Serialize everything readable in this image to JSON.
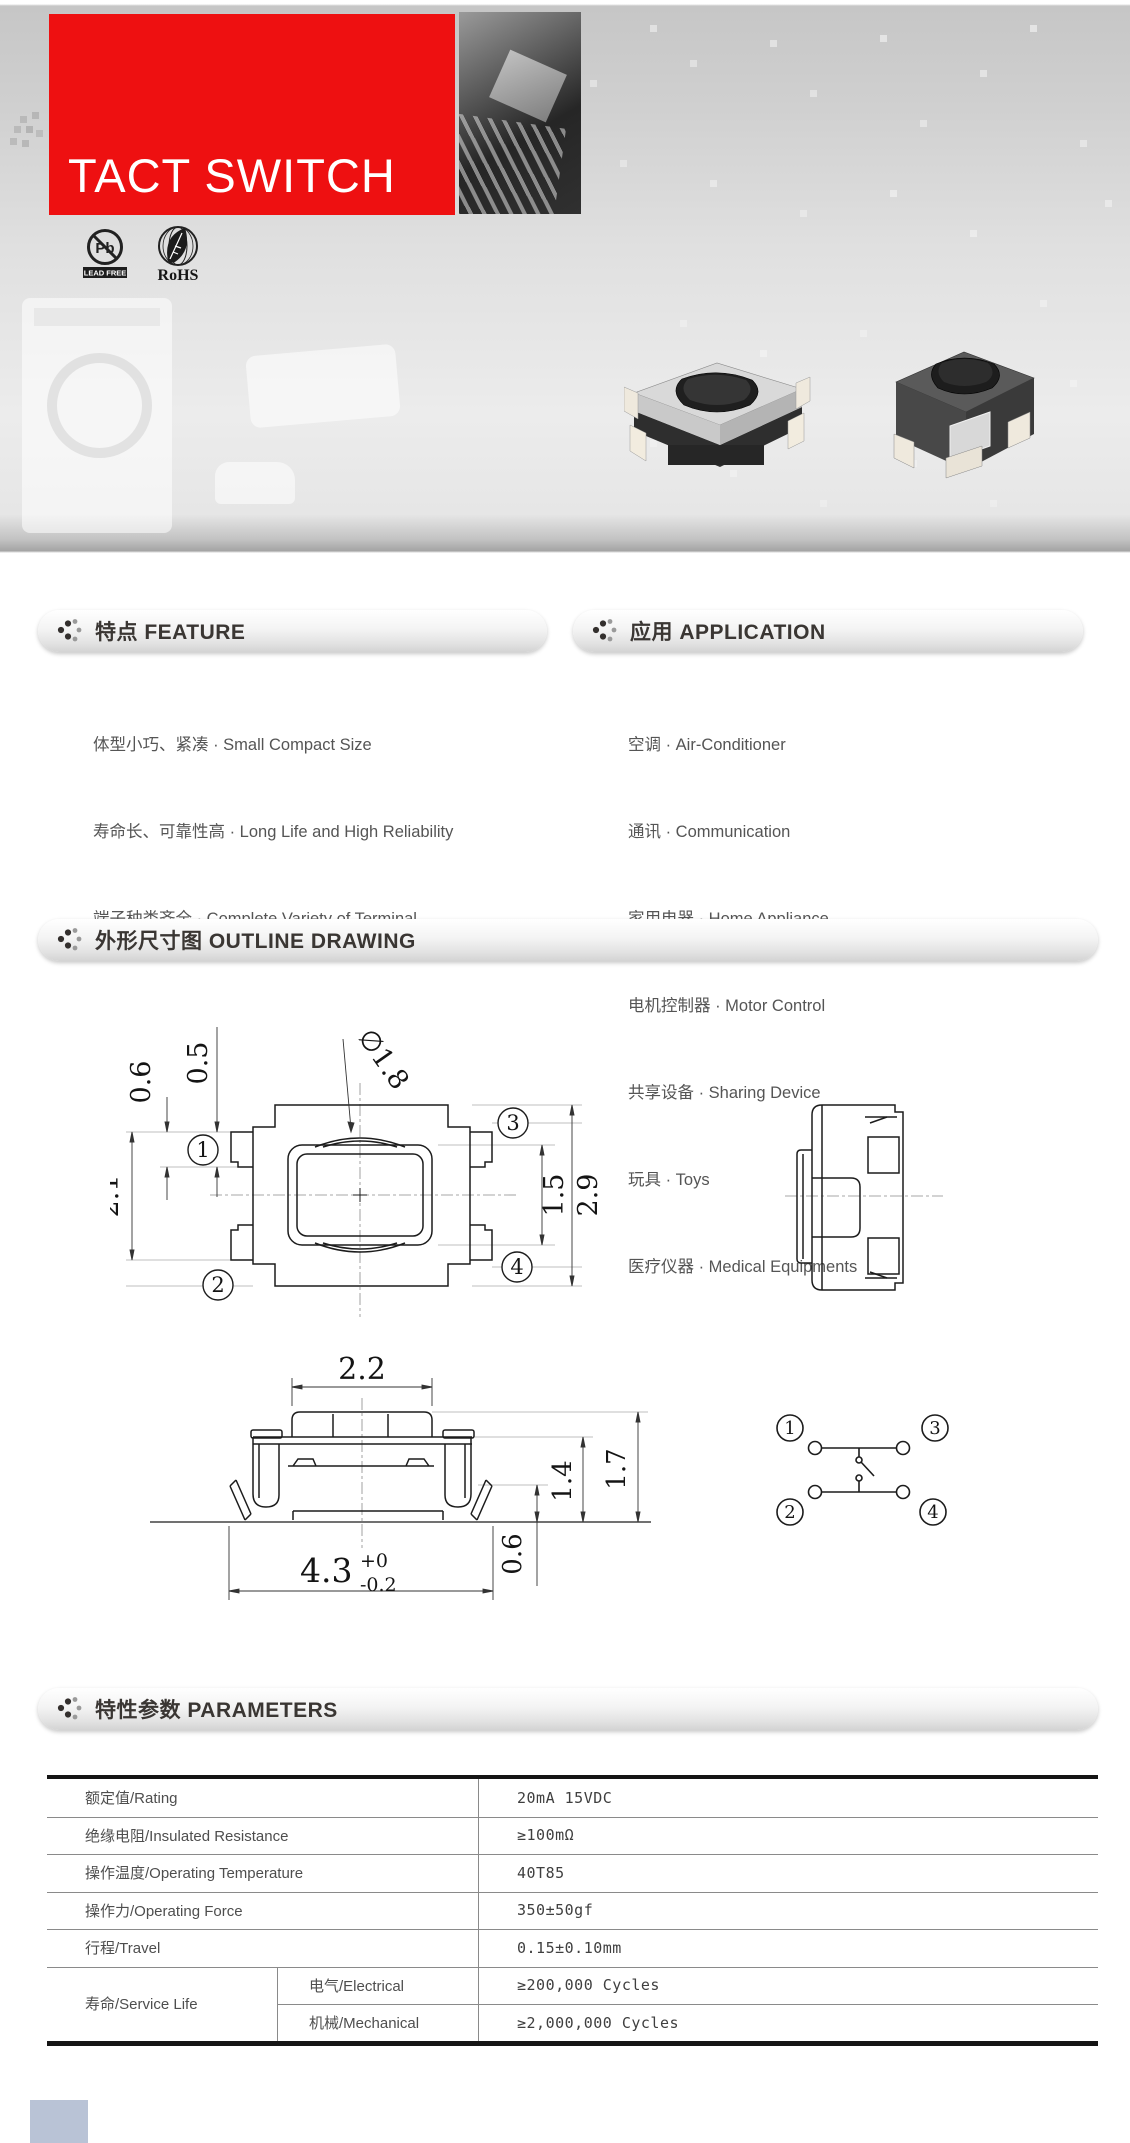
{
  "hero": {
    "title": "TACT SWITCH",
    "badges": {
      "lead_free_symbol": "Pb",
      "lead_free_label": "LEAD FREE",
      "rohs_label": "RoHS"
    }
  },
  "sections": {
    "feature": {
      "title": "特点 FEATURE",
      "items": [
        "体型小巧、紧凑 · Small Compact Size",
        "寿命长、可靠性高 · Long Life and High Reliability",
        "端子种类齐全 · Complete Variety of Terminal"
      ]
    },
    "application": {
      "title": "应用 APPLICATION",
      "items": [
        "空调 · Air-Conditioner",
        "通讯 · Communication",
        "家用电器 · Home Appliance",
        "电机控制器 · Motor Control",
        "共享设备 · Sharing Device",
        "玩具 · Toys",
        "医疗仪器 · Medical Equipments"
      ]
    },
    "outline": {
      "title": "外形尺寸图 OUTLINE DRAWING",
      "top_view": {
        "dims": [
          "0.5",
          "0.6",
          "∅1.8",
          "2.1",
          "1.5",
          "2.9"
        ],
        "pins": [
          "1",
          "2",
          "3",
          "4"
        ]
      },
      "front_view": {
        "dims": [
          "2.2",
          "1.4",
          "1.7",
          "0.6",
          "4.3"
        ],
        "tol": [
          "+0",
          "-0.2"
        ]
      },
      "schematic": {
        "pins": [
          "1",
          "2",
          "3",
          "4"
        ]
      }
    },
    "parameters": {
      "title": "特性参数 PARAMETERS",
      "rows": [
        {
          "label": "额定值/Rating",
          "value": "20mA 15VDC"
        },
        {
          "label": "绝缘电阻/Insulated Resistance",
          "value": "≥100mΩ"
        },
        {
          "label": "操作温度/Operating Temperature",
          "value": "40T85"
        },
        {
          "label": "操作力/Operating Force",
          "value": "350±50gf"
        },
        {
          "label": "行程/Travel",
          "value": "0.15±0.10mm"
        }
      ],
      "service_life": {
        "label": "寿命/Service Life",
        "sub_rows": [
          {
            "label": "电气/Electrical",
            "value": "≥200,000 Cycles"
          },
          {
            "label": "机械/Mechanical",
            "value": "≥2,000,000 Cycles"
          }
        ]
      }
    }
  }
}
